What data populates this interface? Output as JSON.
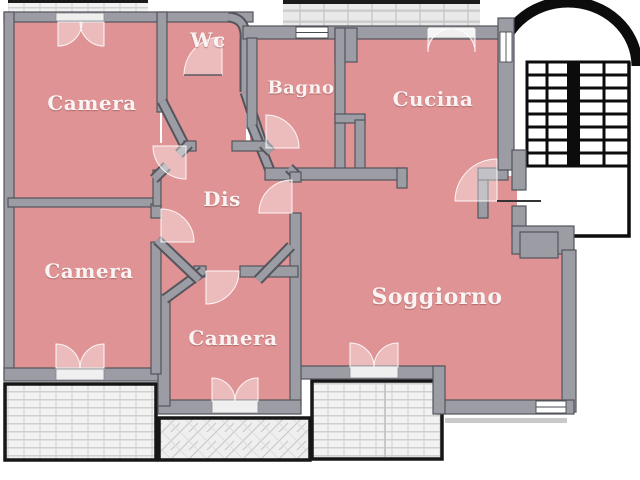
{
  "plan": {
    "type": "apartment-floor-plan",
    "language": "it"
  },
  "rooms": [
    {
      "id": "camera-nw",
      "label": "Camera"
    },
    {
      "id": "wc",
      "label": "Wc"
    },
    {
      "id": "bagno",
      "label": "Bagno"
    },
    {
      "id": "cucina",
      "label": "Cucina"
    },
    {
      "id": "dis",
      "label": "Dis"
    },
    {
      "id": "camera-w",
      "label": "Camera"
    },
    {
      "id": "camera-s",
      "label": "Camera"
    },
    {
      "id": "soggiorno",
      "label": "Soggiorno"
    }
  ],
  "features": {
    "stairwell": "stairwell-with-two-flights",
    "entry_door": "entry-door-from-landing",
    "terrace_top_left": "terrace",
    "terrace_top_center": "terrace",
    "balcony_bottom_left": "balcony",
    "balcony_bottom_center": "balcony",
    "balcony_bottom_right": "balcony"
  },
  "colors": {
    "room_fill": "#e09394",
    "wall": "#9b9ca4",
    "wall_outline": "#54555c",
    "balcony_tile": "#f1f1f1",
    "balcony_border": "#161616",
    "stairs": "#0c0c0c",
    "background": "#ffffff",
    "label_text": "#faf3f3"
  }
}
